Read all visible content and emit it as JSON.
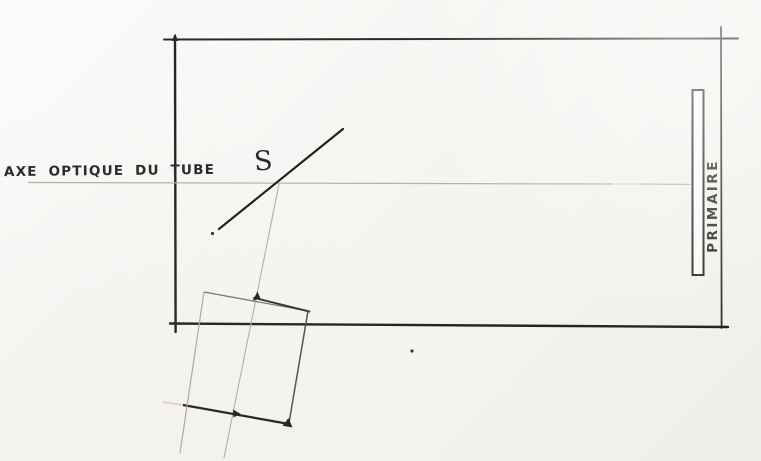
{
  "diagram": {
    "kind": "hand-drawn telescope optical schematic (pencil and ink on scanned paper)",
    "labels": {
      "optical_axis": "AXE OPTIQUE DU TUBE",
      "secondary_mirror": "S",
      "primary_mirror": "PRIMAIRE"
    },
    "elements": [
      {
        "name": "telescope-tube",
        "shape": "large rectangle in ink"
      },
      {
        "name": "optical-axis",
        "shape": "faint horizontal pencil line through tube",
        "label": "AXE OPTIQUE DU TUBE"
      },
      {
        "name": "secondary-mirror",
        "shape": "diagonal ink line crossing the axis",
        "label": "S"
      },
      {
        "name": "reflected-axis",
        "shape": "faint pencil line from secondary down through focuser square"
      },
      {
        "name": "focuser-square",
        "shape": "tilted square below tube with arrow ticks"
      },
      {
        "name": "primary-mirror",
        "shape": "tall thin rectangle at right end of tube",
        "label": "PRIMAIRE"
      }
    ],
    "colors": {
      "paper": "#f5f4f1",
      "ink": "#2b2a28",
      "pencil": "#b4b0a8"
    }
  }
}
